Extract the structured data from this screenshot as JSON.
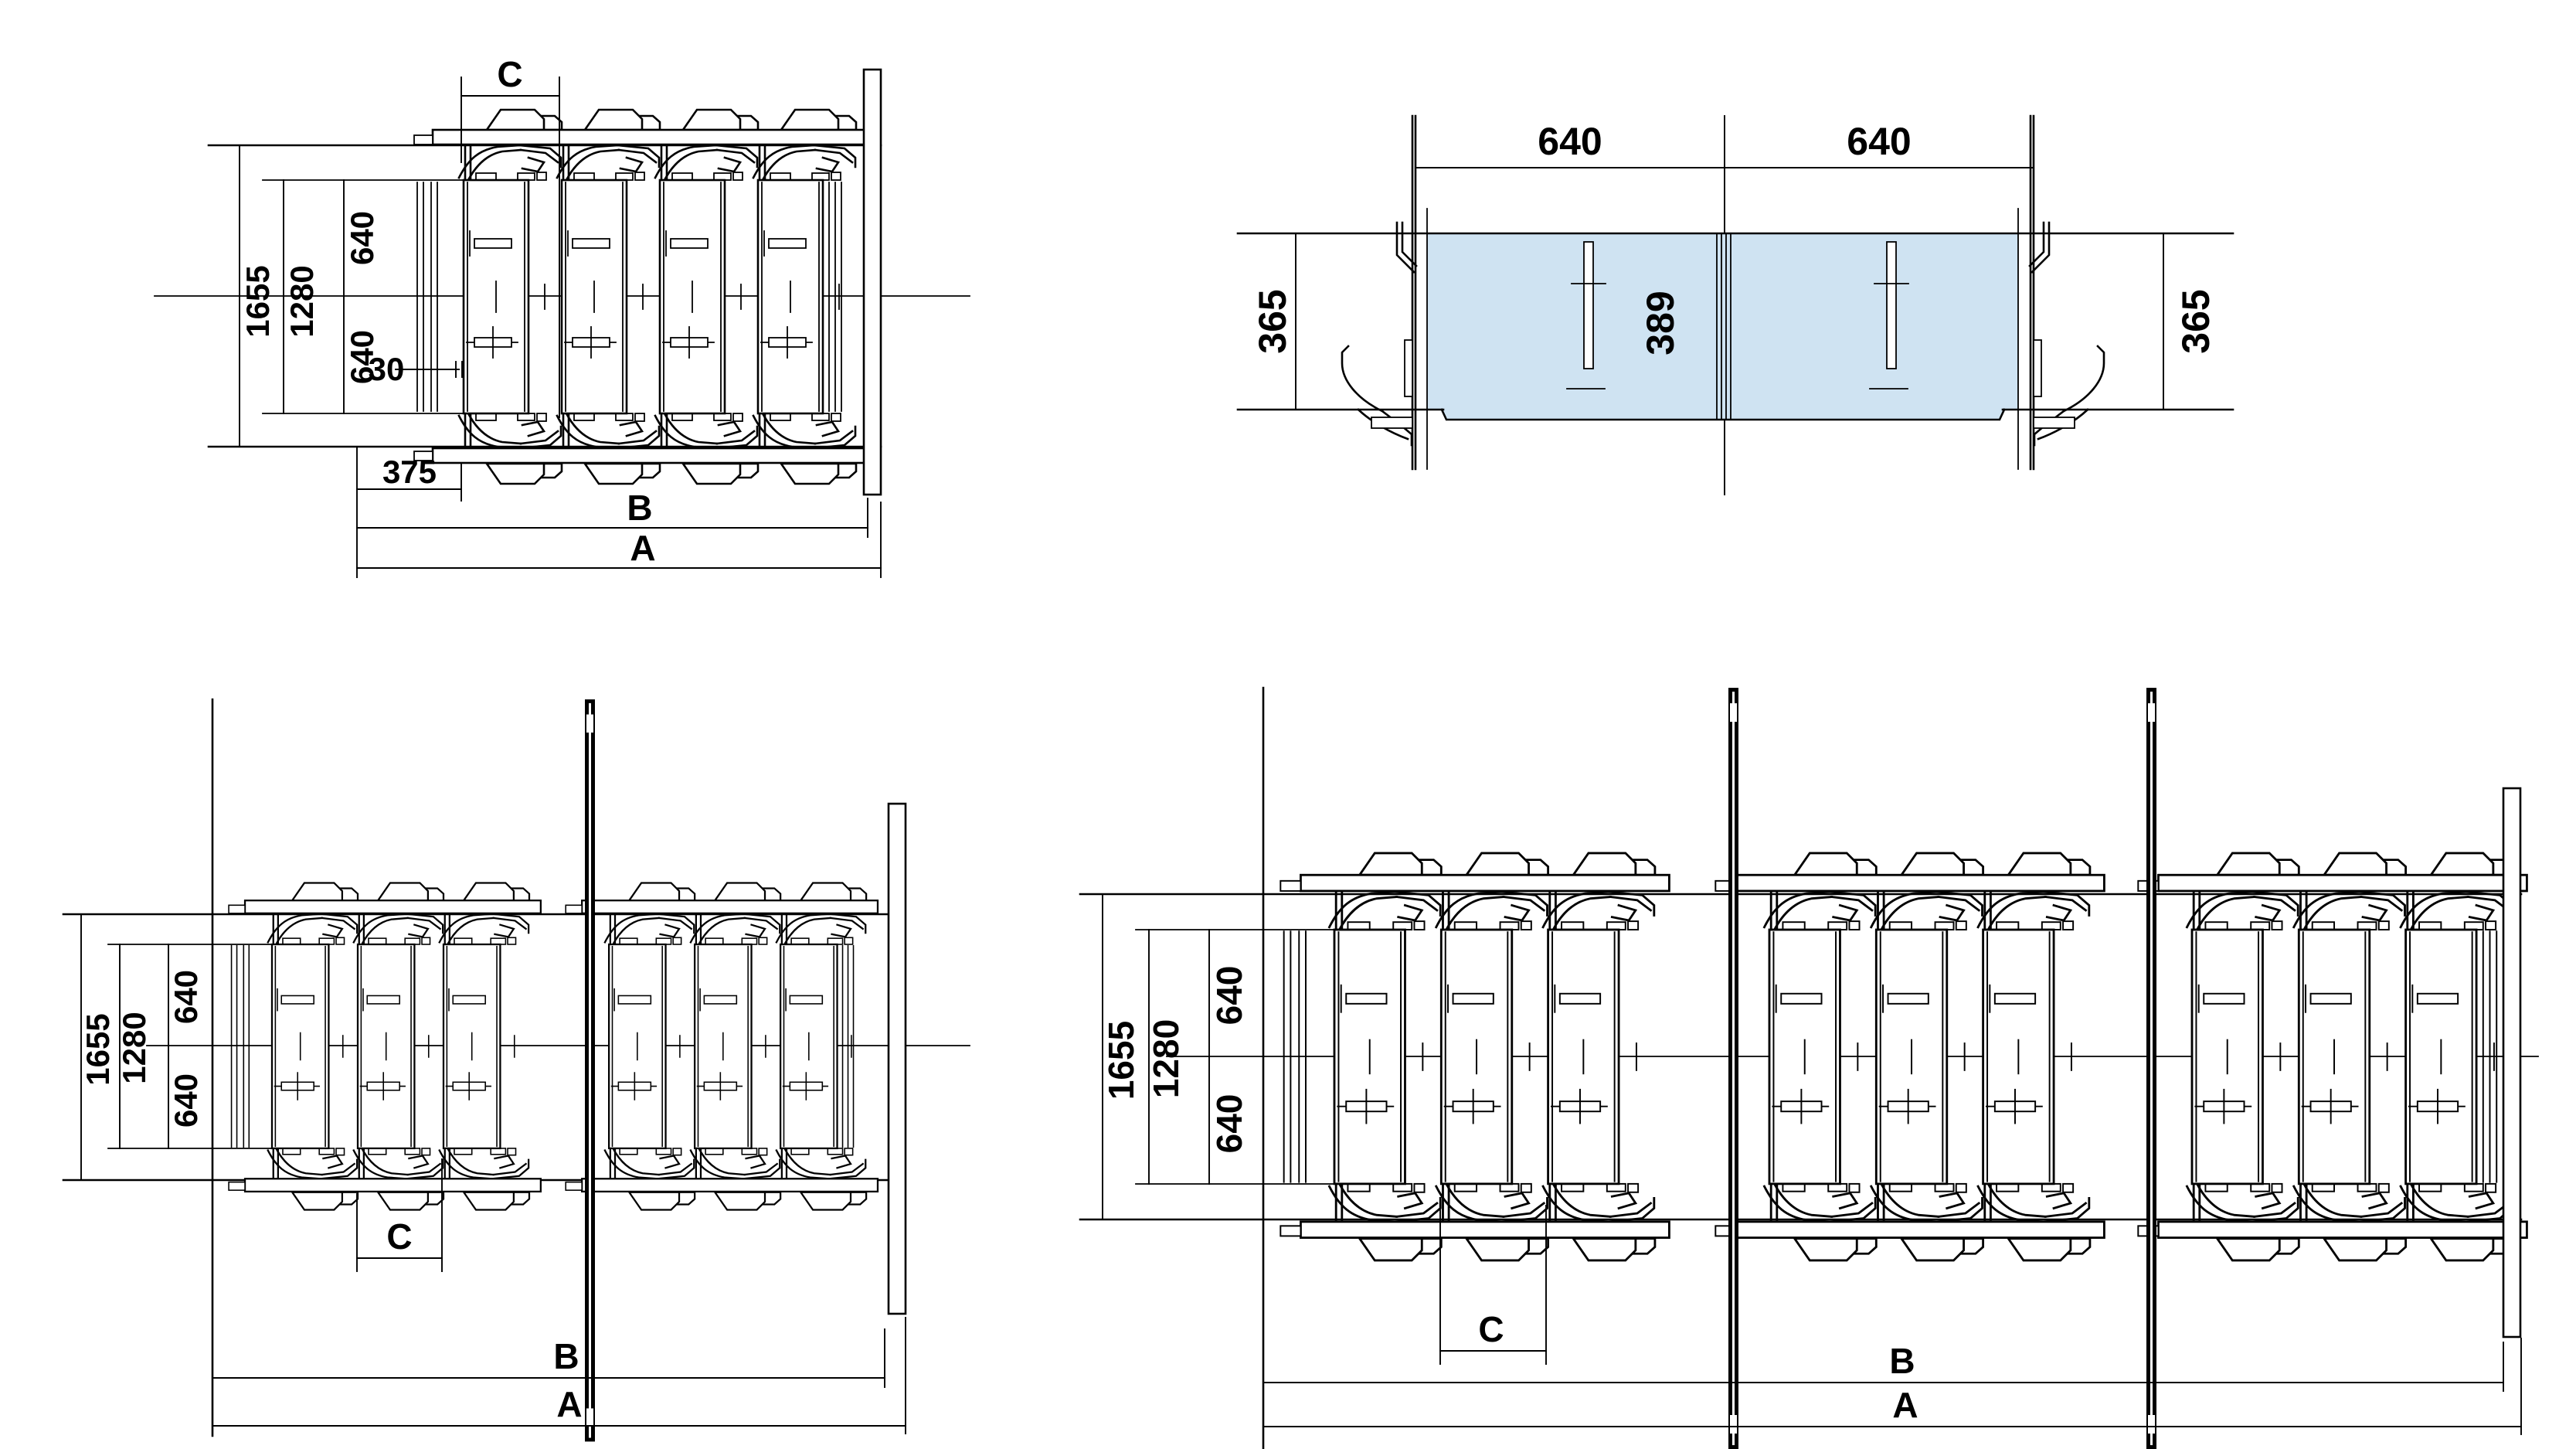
{
  "title": "parking-platform-system-technical-drawing",
  "palette": {
    "line_color": "#000000",
    "platform_fill": "#cfe3f2",
    "background": "#ffffff"
  },
  "top_left_plan": {
    "dim_c": "C",
    "dim_640_top": "640",
    "dim_1280": "1280",
    "dim_1655": "1655",
    "dim_640_bottom": "640",
    "dim_30": "30",
    "dim_375": "375",
    "dim_b": "B",
    "dim_a": "A"
  },
  "top_right_section": {
    "dim_640_left": "640",
    "dim_640_right": "640",
    "dim_365_left": "365",
    "dim_389": "389",
    "dim_365_right": "365"
  },
  "bottom_left_plan": {
    "dim_640_top": "640",
    "dim_1280": "1280",
    "dim_1655": "1655",
    "dim_640_bottom": "640",
    "dim_c": "C",
    "dim_b": "B",
    "dim_a": "A"
  },
  "bottom_right_plan": {
    "dim_640_top": "640",
    "dim_1280": "1280",
    "dim_1655": "1655",
    "dim_640_bottom": "640",
    "dim_c": "C",
    "dim_b": "B",
    "dim_a": "A"
  }
}
